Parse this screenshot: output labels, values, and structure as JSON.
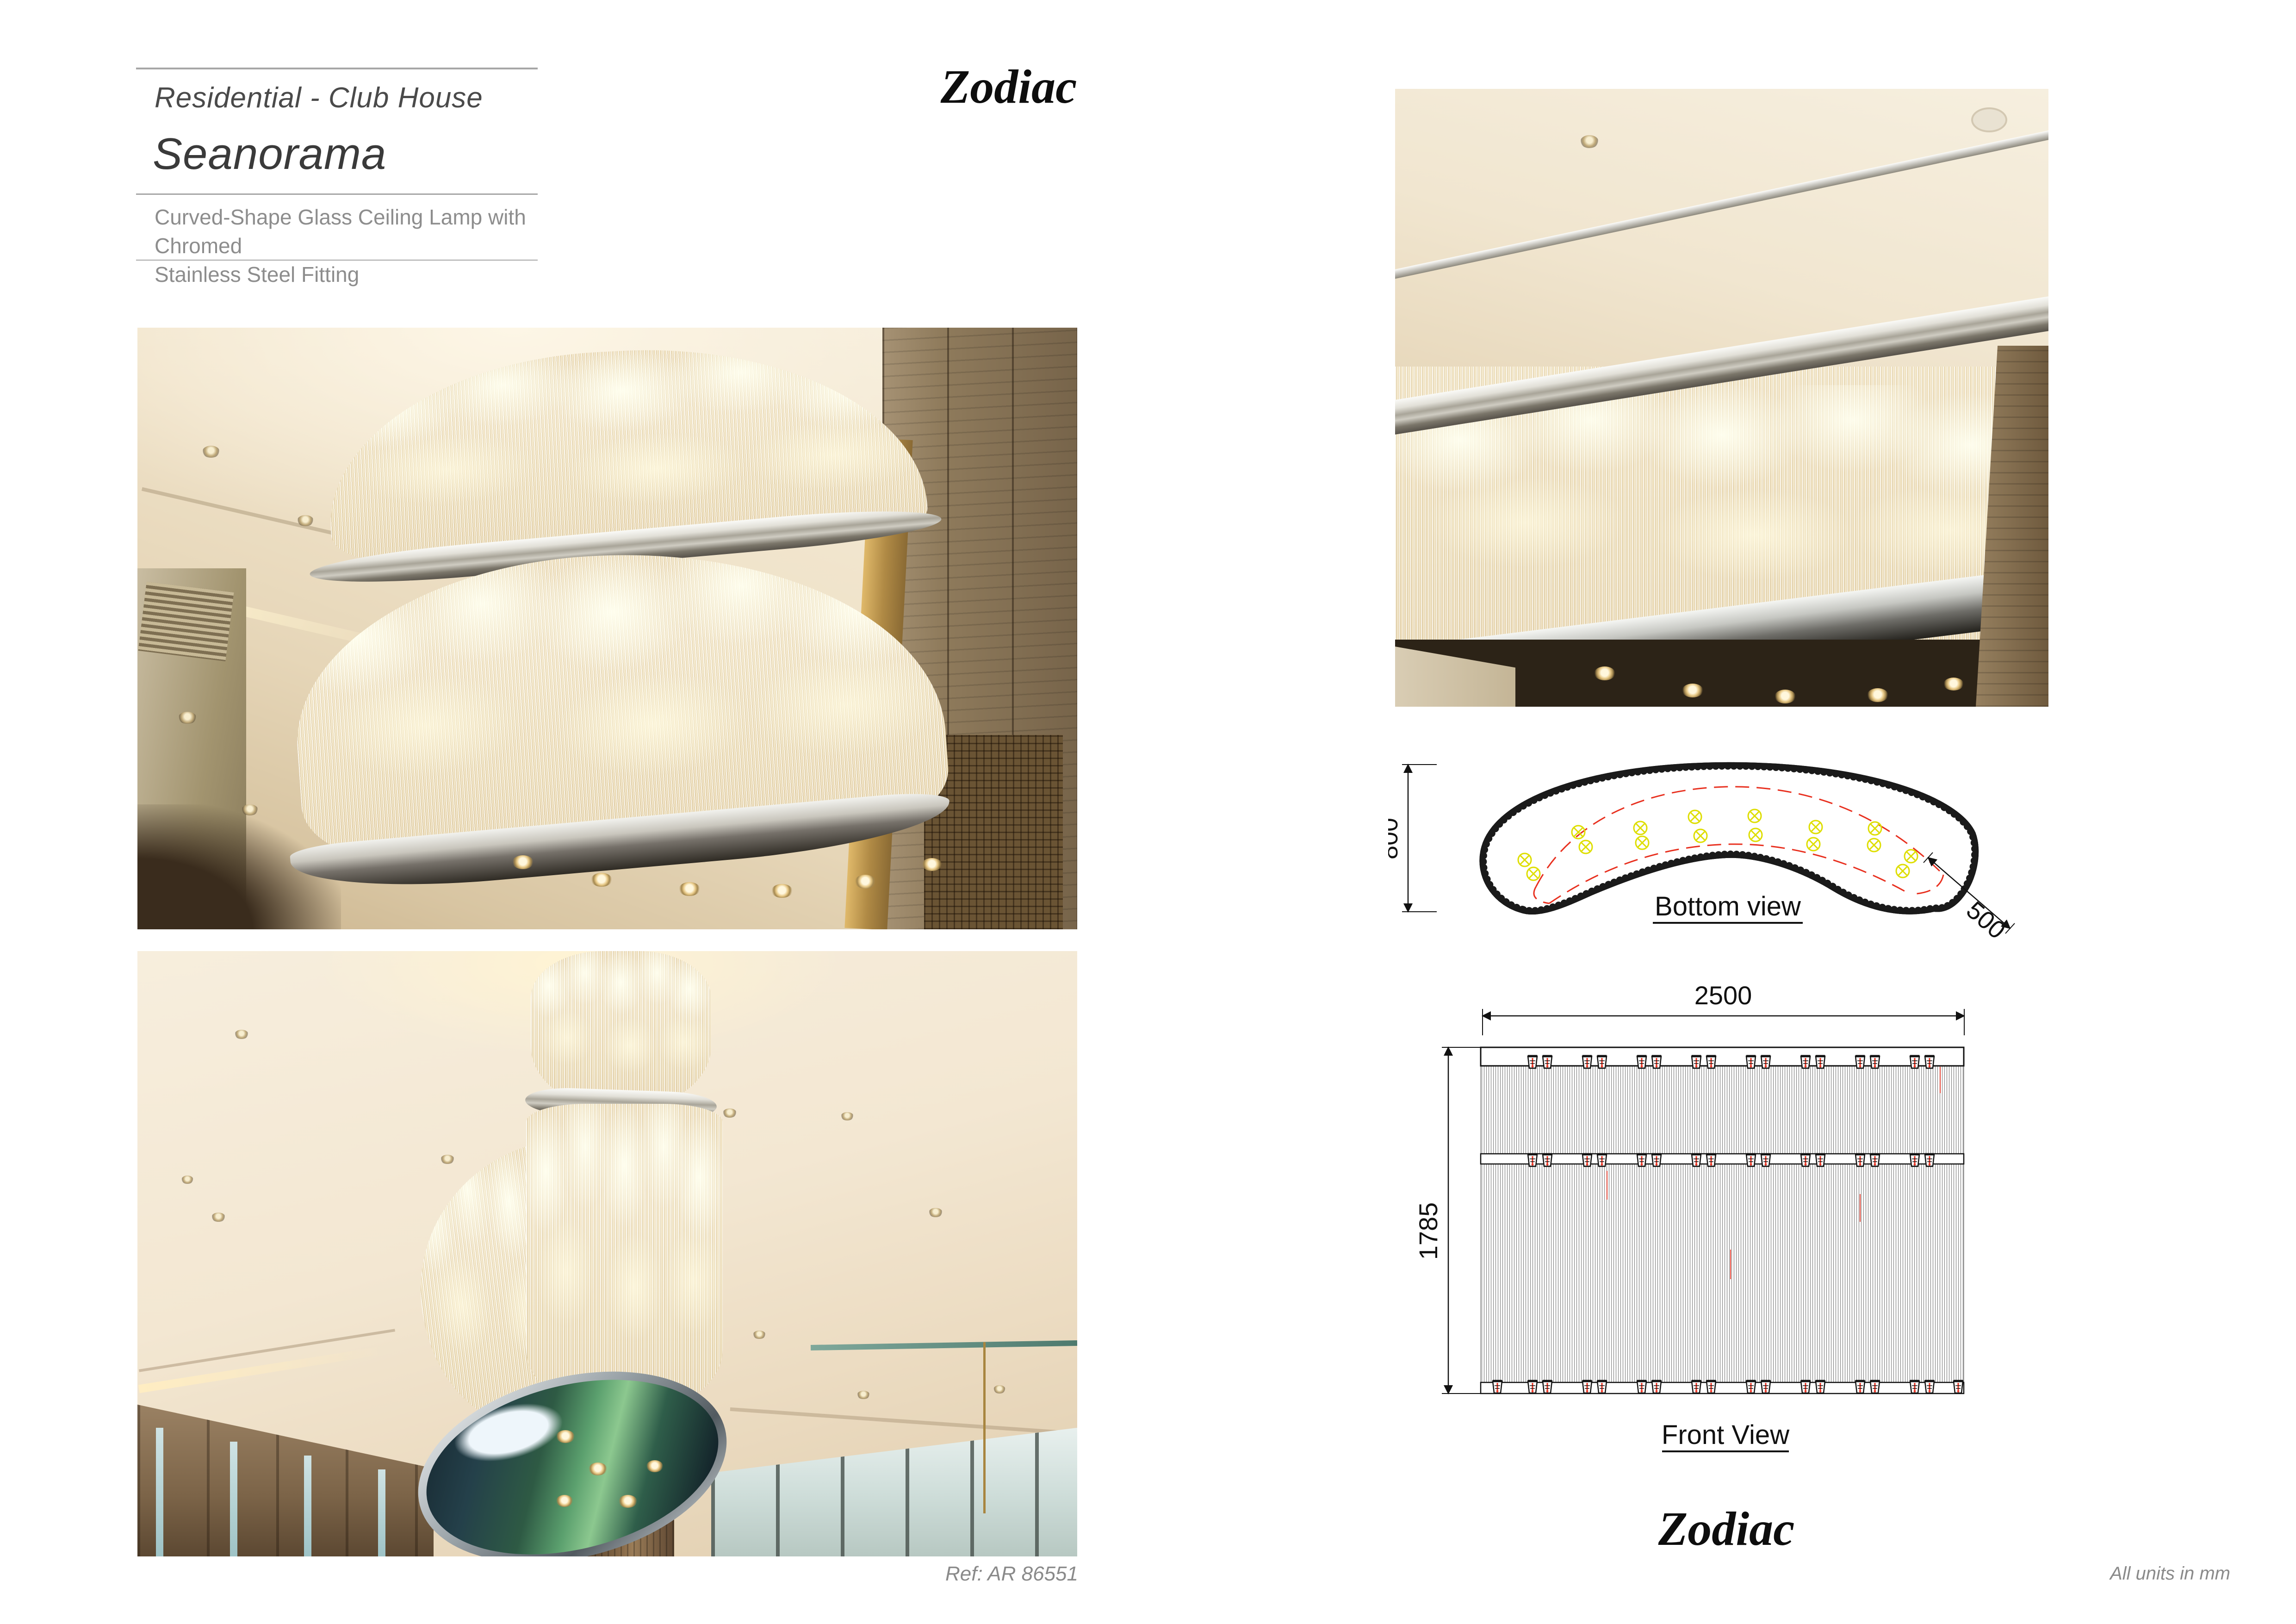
{
  "header": {
    "category": "Residential - Club House",
    "product": "Seanorama",
    "description": [
      "Curved-Shape Glass Ceiling Lamp with Chromed",
      "Stainless Steel Fitting"
    ]
  },
  "brand": {
    "logo": "Zodiac"
  },
  "drawings": {
    "bottom_view": {
      "label": "Bottom view",
      "dim_height_mm": "800",
      "dim_depth_mm": "500"
    },
    "front_view": {
      "label": "Front View",
      "dim_width_mm": "2500",
      "dim_height_mm": "1785"
    }
  },
  "footer": {
    "ref": "Ref: AR 86551",
    "units": "All units in mm"
  },
  "colors": {
    "drawing_red": "#e8301f",
    "drawing_yellow": "#dede00",
    "ink": "#111111",
    "text_gray": "#8a8a8a"
  }
}
